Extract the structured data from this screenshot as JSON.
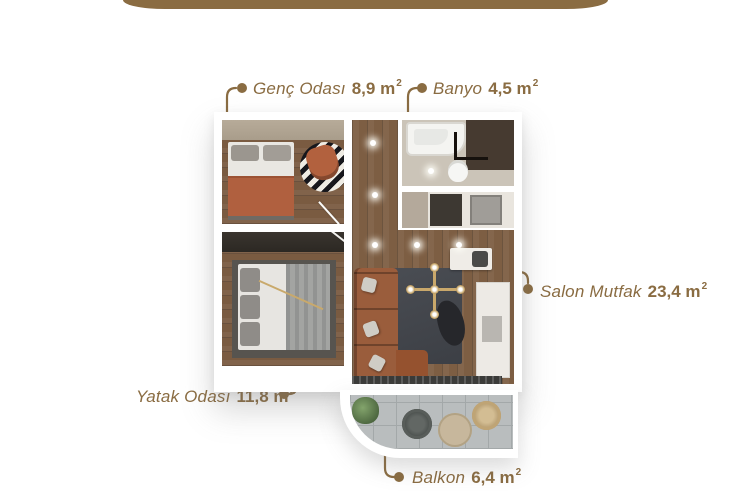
{
  "colors": {
    "accent": "#8a6c42"
  },
  "decor": {
    "top_band": "gold-rounded-band"
  },
  "labels": [
    {
      "name": "Genç Odası",
      "area": "8,9 m",
      "sup": "2"
    },
    {
      "name": "Banyo",
      "area": "4,5 m",
      "sup": "2"
    },
    {
      "name": "Salon Mutfak",
      "area": "23,4 m",
      "sup": "2"
    },
    {
      "name": "Yatak Odası",
      "area": "11,8 m",
      "sup": "2"
    },
    {
      "name": "Balkon",
      "area": "6,4 m",
      "sup": "2"
    }
  ]
}
